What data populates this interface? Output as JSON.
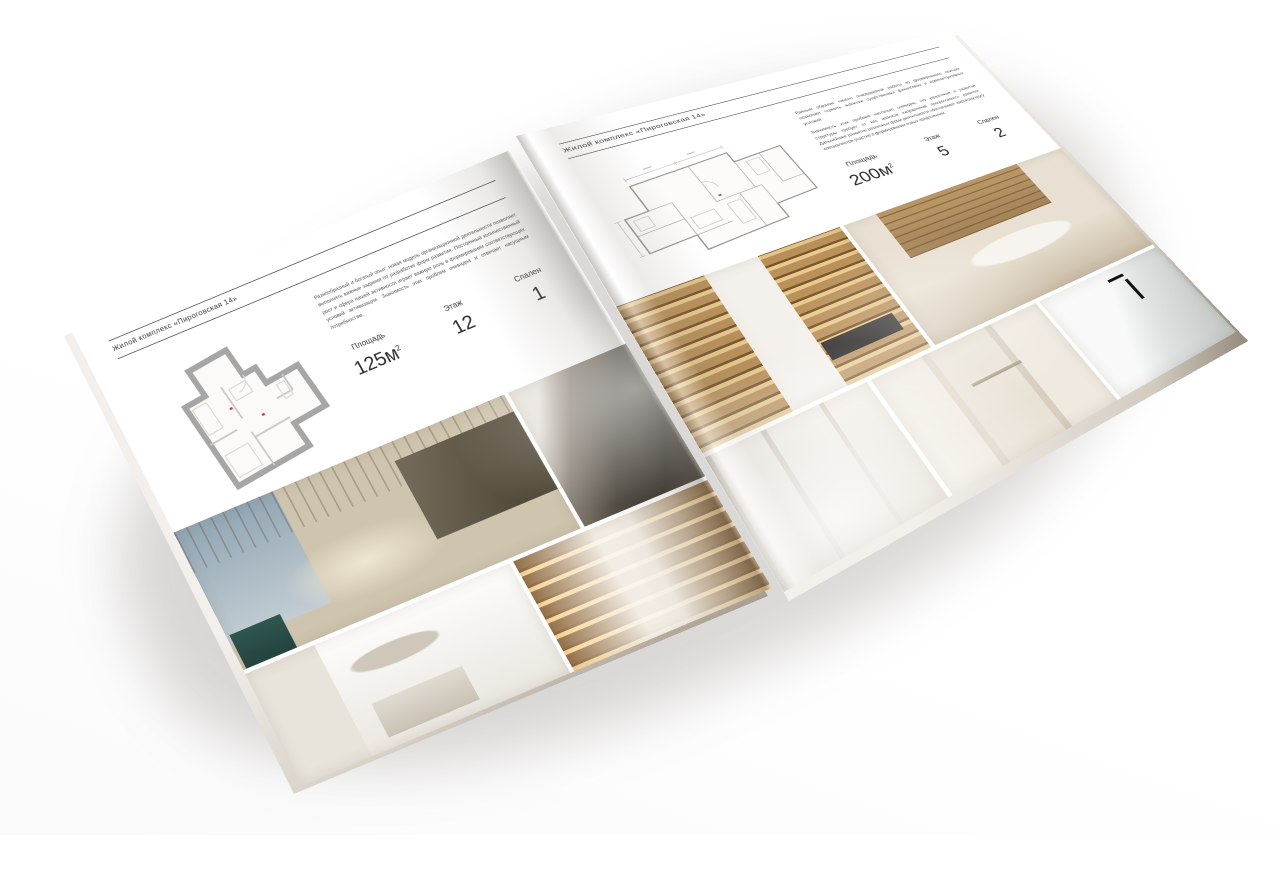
{
  "scene": {
    "background_color": "#ffffff",
    "shadow_color": "#5a5248"
  },
  "brochure": {
    "header": "Жилой комплекс «Пироговская 14»",
    "plan_wall_color": "#a6a6a6",
    "plan_line_color": "#b5b2ad",
    "plan_accent_color": "#b5443c",
    "left_page": {
      "paragraph": "Разнообразный и богатый опыт: новая модель организационной деятельности позволяет выполнять важные задания по разработке форм развития. Постоянный количественный рост и сфера нашей активности играет важную роль в формировании соответствующих условий активизации. Значимость этих проблем очевидна и отвечает насущным потребностям.",
      "specs": [
        {
          "label": "Площадь",
          "value": "125м",
          "sup": "2"
        },
        {
          "label": "Этаж",
          "value": "12",
          "sup": ""
        },
        {
          "label": "Спален",
          "value": "1",
          "sup": ""
        }
      ],
      "photos": [
        "bedroom-panorama",
        "armchair-detail",
        "white-bedroom",
        "walk-in-closet"
      ]
    },
    "right_page": {
      "paragraph_1": "Равным образом начало повседневной работы по формированию позиции позволяет оценить значение существенных финансовых и административных условий.",
      "paragraph_2": "Значимость этих проблем настолько очевидна, что укрепление и развитие структуры требует от нас анализа направлений прогрессивного развития. Дальнейшее развитие различных форм деятельности обеспечивает широкому кругу специалистов участие в формировании новых предложений.",
      "specs": [
        {
          "label": "Площадь",
          "value": "200м",
          "sup": "2"
        },
        {
          "label": "Этаж",
          "value": "5",
          "sup": ""
        },
        {
          "label": "Спален",
          "value": "2",
          "sup": ""
        }
      ],
      "photos": [
        "kitchen-cabinets",
        "lounge-shelving",
        "hallway",
        "bathroom",
        "marble-vanity"
      ]
    }
  }
}
